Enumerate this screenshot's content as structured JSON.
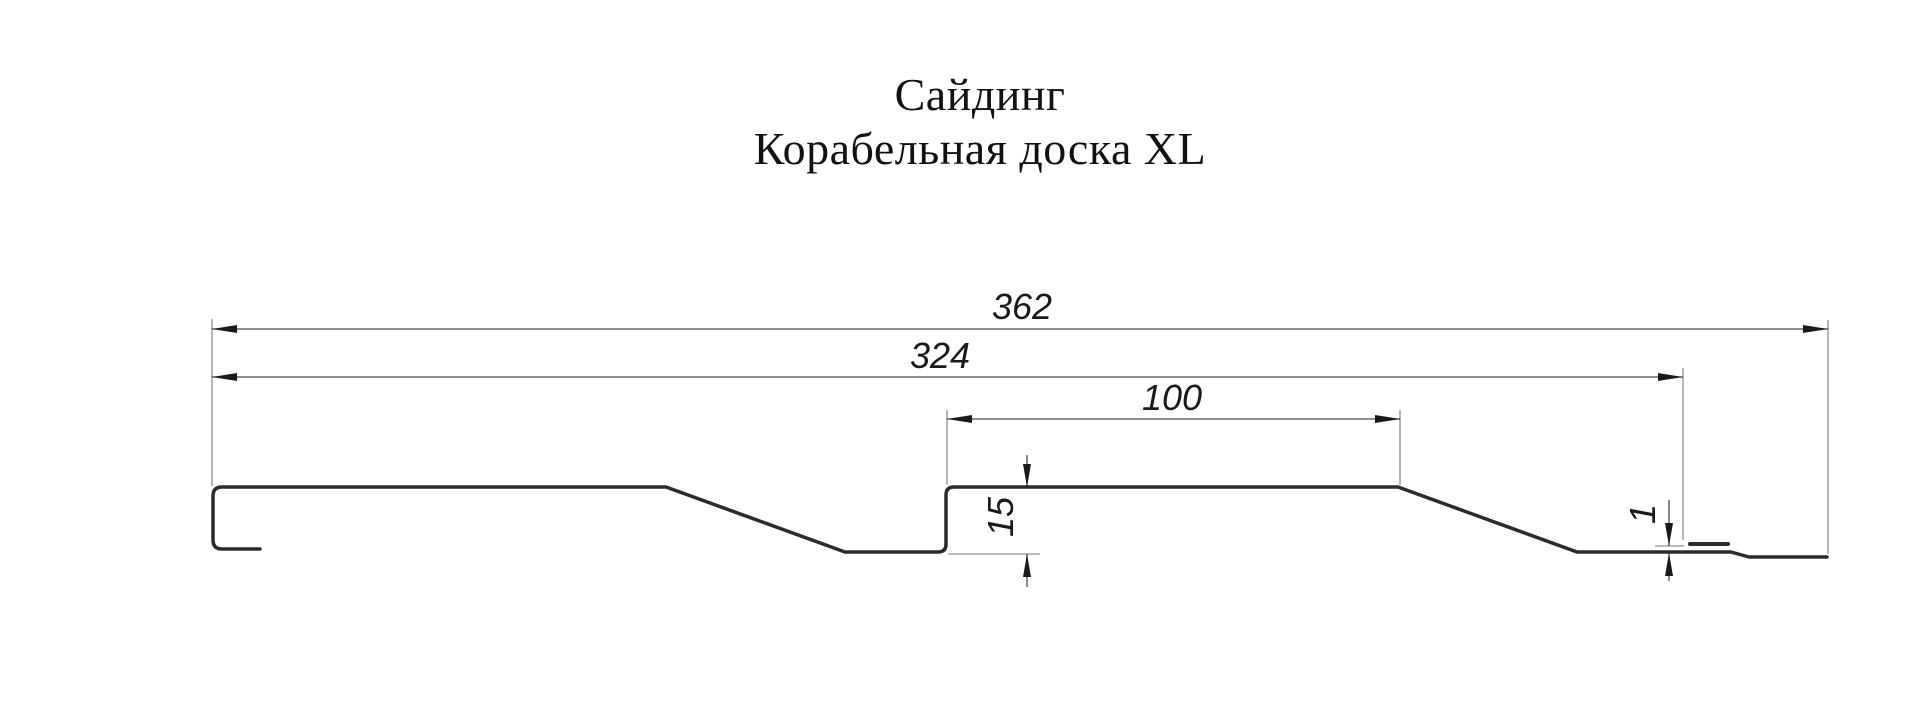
{
  "title": {
    "line1": "Сайдинг",
    "line2": "Корабельная доска XL"
  },
  "dimensions": [
    {
      "id": "overall-width",
      "label": "362",
      "orientation": "horizontal"
    },
    {
      "id": "working-width",
      "label": "324",
      "orientation": "horizontal"
    },
    {
      "id": "plank-width",
      "label": "100",
      "orientation": "horizontal"
    },
    {
      "id": "profile-depth",
      "label": "15",
      "orientation": "vertical"
    },
    {
      "id": "edge-thickness",
      "label": "1",
      "orientation": "vertical"
    }
  ],
  "colors": {
    "background": "#ffffff",
    "profile_outline": "#2b2b2b",
    "dimension_lines": "#4a4a4a",
    "extension_lines": "#7a7a7a",
    "text": "#1a1a1a"
  }
}
